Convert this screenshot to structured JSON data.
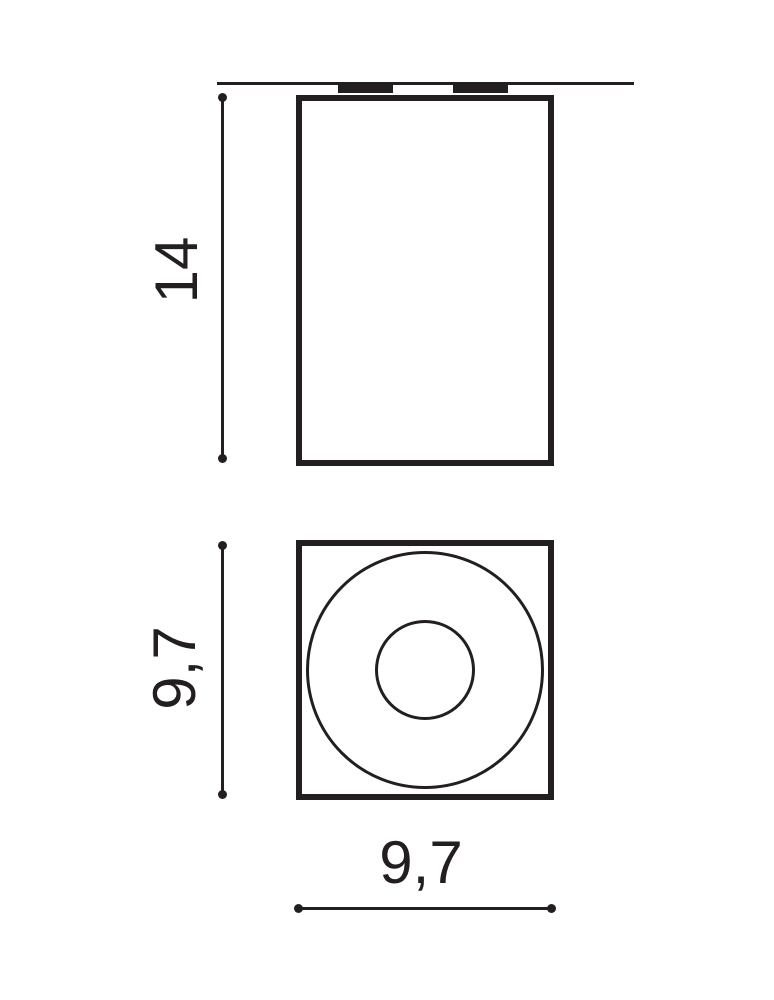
{
  "drawing": {
    "kind": "luminaire-dimension-drawing",
    "background_color": "#ffffff",
    "line_color": "#231f20",
    "front_view": {
      "height_dimension": "14"
    },
    "bottom_view": {
      "side_dimension": "9,7",
      "width_dimension": "9,7"
    }
  }
}
